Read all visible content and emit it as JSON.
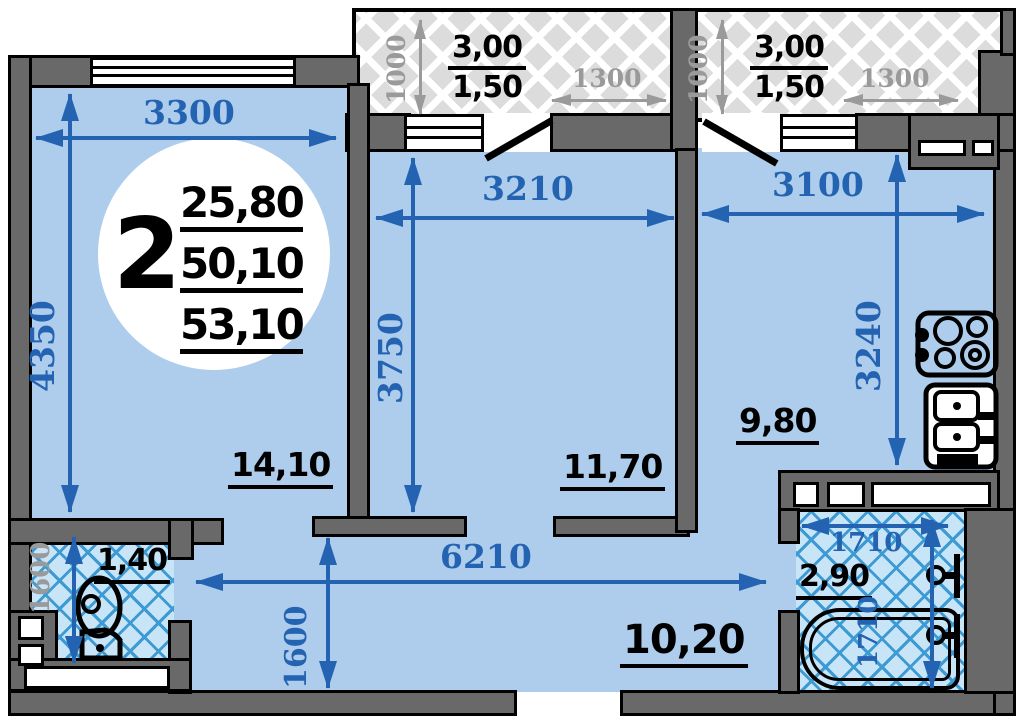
{
  "colors": {
    "wall": "#696969",
    "floor": "#aecdec",
    "dim": "#2363b1",
    "gray": "#9a9a9a",
    "tile_bg": "#c8e4f7",
    "tile_line": "#3d9ad2",
    "hatch_bg": "#dcdcdc"
  },
  "unit": {
    "room_count": "2",
    "area_1": "25,80",
    "area_2": "50,10",
    "area_3": "53,10"
  },
  "rooms": {
    "living": {
      "area": "14,10",
      "width": "3300",
      "depth": "4350"
    },
    "bedroom": {
      "area": "11,70",
      "width": "3210",
      "depth": "3750"
    },
    "kitchen": {
      "area": "9,80",
      "width": "3100",
      "depth": "3240"
    },
    "hallway": {
      "area": "10,20",
      "width": "6210",
      "depth": "1600"
    },
    "wc": {
      "area": "1,40",
      "depth": "1600"
    },
    "bathroom": {
      "area": "2,90",
      "width": "1710",
      "depth": "1710"
    },
    "balcony_left": {
      "area_a": "3,00",
      "area_b": "1,50",
      "depth": "1000",
      "width": "1300"
    },
    "balcony_right": {
      "area_a": "3,00",
      "area_b": "1,50",
      "depth": "1000",
      "width": "1300"
    }
  }
}
